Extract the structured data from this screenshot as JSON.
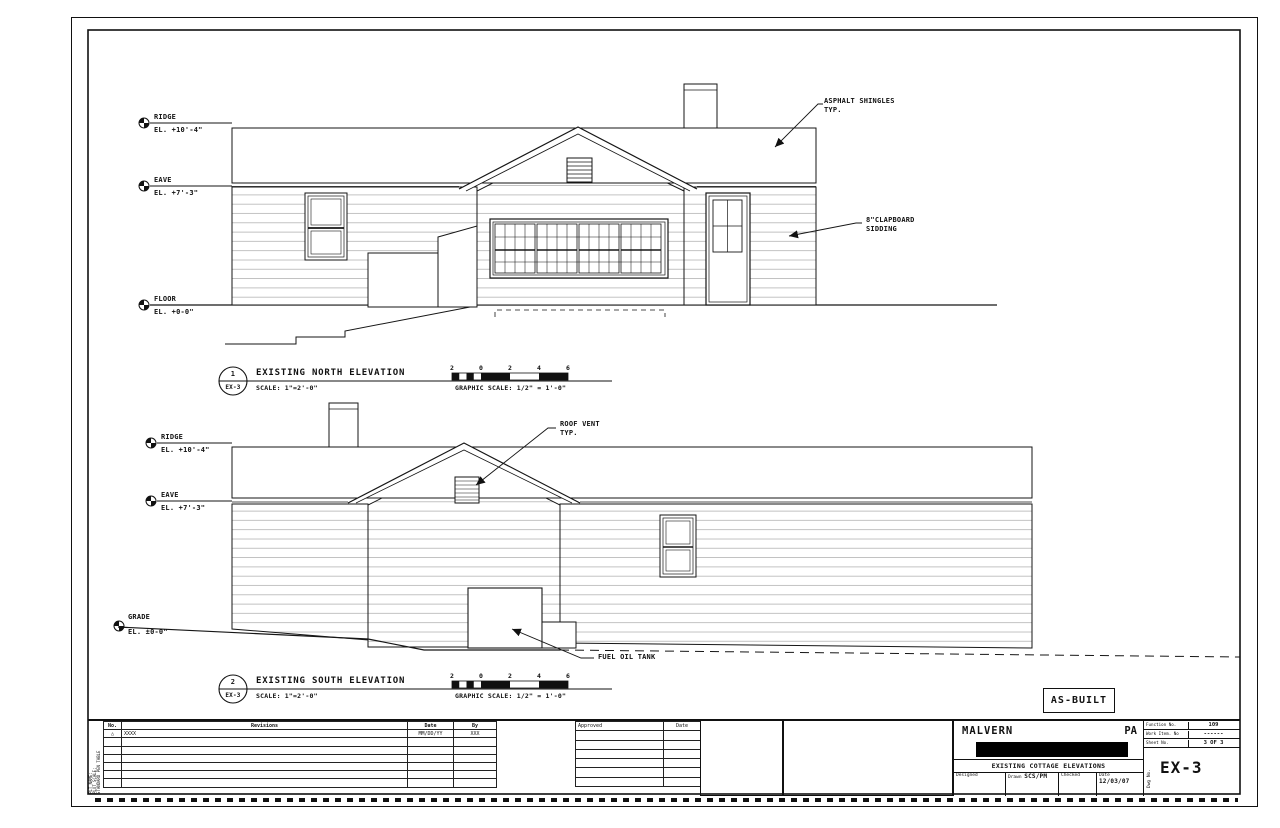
{
  "sheet": {
    "stamp": "AS-BUILT"
  },
  "north": {
    "datums": {
      "ridge": {
        "name": "RIDGE",
        "el": "EL. +10'-4\""
      },
      "eave": {
        "name": "EAVE",
        "el": "EL. +7'-3\""
      },
      "floor": {
        "name": "FLOOR",
        "el": "EL. +0-0\""
      }
    },
    "annotations": {
      "shingles": [
        "ASPHALT SHINGLES",
        "TYP."
      ],
      "siding": [
        "8\"CLAPBOARD",
        "SIDDING"
      ]
    },
    "title": {
      "number": "1",
      "sheet_ref": "EX-3",
      "text": "EXISTING NORTH ELEVATION",
      "scale": "SCALE: 1\"=2'-0\""
    }
  },
  "south": {
    "datums": {
      "ridge": {
        "name": "RIDGE",
        "el": "EL. +10'-4\""
      },
      "eave": {
        "name": "EAVE",
        "el": "EL. +7'-3\""
      },
      "grade": {
        "name": "GRADE",
        "el": "EL. ±0-0\""
      }
    },
    "annotations": {
      "roof_vent": [
        "ROOF VENT",
        "TYP."
      ],
      "fuel_tank": "FUEL OIL TANK"
    },
    "title": {
      "number": "2",
      "sheet_ref": "EX-3",
      "text": "EXISTING SOUTH ELEVATION",
      "scale": "SCALE: 1\"=2'-0\""
    }
  },
  "graphic_scale": {
    "ticks": [
      "2",
      "0",
      "2",
      "4",
      "6"
    ],
    "caption": "GRAPHIC SCALE: 1/2\" = 1'-0\""
  },
  "titleblock": {
    "revisions": {
      "headers": {
        "no": "No.",
        "revisions": "Revisions",
        "date": "Date",
        "by": "By"
      },
      "row1": {
        "no": "△",
        "revisions": "XXXX",
        "date": "MM/DD/YY",
        "by": "XXX"
      }
    },
    "margin_note": [
      "PLT NAME:",
      "PLOT SCALE:",
      "STANDARD PEN TABLE"
    ],
    "approved": {
      "headers": {
        "approved": "Approved",
        "date": "Date"
      }
    },
    "project": {
      "city": "MALVERN",
      "state": "PA",
      "drawing_title": "EXISTING COTTAGE ELEVATIONS",
      "designed_label": "Designed",
      "drawn_label": "Drawn",
      "drawn_value": "SCS/PM",
      "checked_label": "Checked",
      "date_label": "Date",
      "date_value": "12/03/07"
    },
    "sheet_info": {
      "function_label": "Function No.",
      "function_value": "109",
      "work_item_label": "Work Item. No",
      "work_item_value": "------",
      "sheet_no_label": "Sheet No.",
      "sheet_no_value": "3 OF 3",
      "dwg_label": "Dwg No.",
      "dwg_value": "EX-3"
    }
  }
}
